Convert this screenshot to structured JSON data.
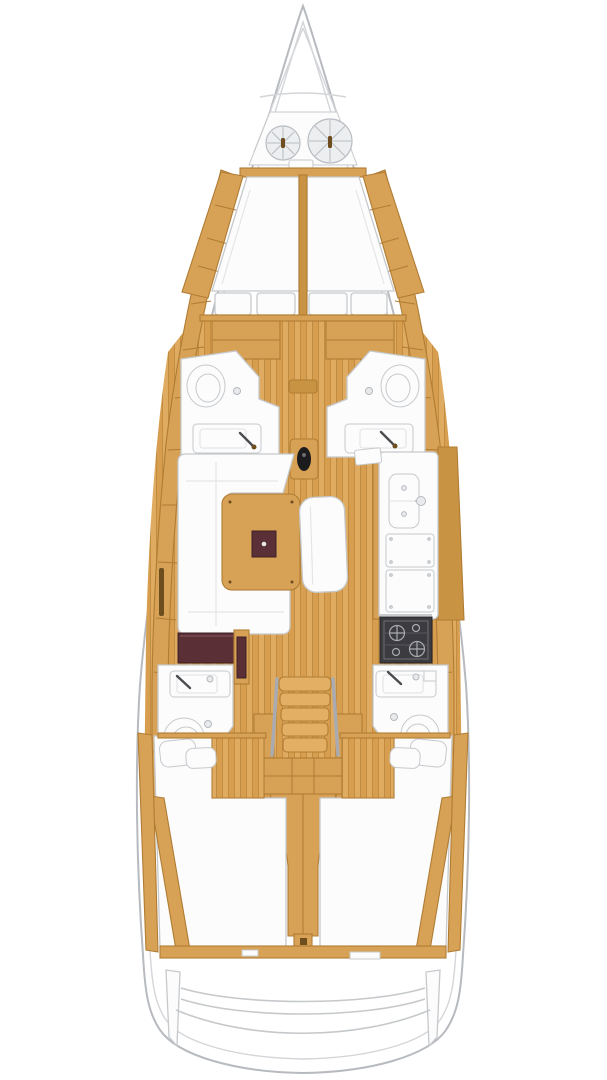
{
  "diagram": {
    "type": "boat-interior-floor-plan",
    "label": "sailboat interior layout top view, bow at top",
    "orientation": "bow-top",
    "features": {
      "bow": [
        "anchor-locker",
        "rope-coil-port",
        "rope-coil-starboard",
        "windlass",
        "stem-lines"
      ],
      "forward_cabin": [
        "v-berth-port-mattress",
        "v-berth-starboard-mattress",
        "berth-center-divider",
        "side-shelf-port",
        "side-shelf-starboard",
        "foot-cushion-1",
        "foot-cushion-2",
        "foot-cushion-3",
        "foot-cushion-4",
        "storage-locker-port",
        "storage-locker-starboard"
      ],
      "forward_head_port": [
        "toilet",
        "washbasin",
        "faucet",
        "floor-drain"
      ],
      "forward_head_starboard": [
        "toilet",
        "washbasin",
        "faucet",
        "floor-drain"
      ],
      "mast": [
        "mast-step-threshold",
        "mast-post"
      ],
      "salon": [
        "u-shaped-settee",
        "saloon-table",
        "table-folding-leaf",
        "bench-seat",
        "nav-seat",
        "chart-table"
      ],
      "galley": [
        "counter",
        "double-sink",
        "faucet",
        "locker-panel-upper",
        "locker-panel-lower",
        "stove-oven",
        "locker-door",
        "cabinet-face"
      ],
      "aft_head_port": [
        "washbasin",
        "faucet",
        "toilet",
        "floor-drain"
      ],
      "aft_head_starboard": [
        "washbasin",
        "faucet",
        "toilet",
        "floor-drain",
        "shelf-box"
      ],
      "companionway": [
        "stairs",
        "handrail-port",
        "handrail-starboard",
        "engine-compartment",
        "shaft-tunnel"
      ],
      "aft_cabin_port": [
        "double-berth",
        "pillows",
        "wood-floor",
        "structural-beam",
        "hull-stringer"
      ],
      "aft_cabin_starboard": [
        "double-berth",
        "pillows",
        "wood-floor",
        "structural-beam",
        "hull-stringer"
      ],
      "stern": [
        "aft-bulkhead-beam",
        "transom-panel-port",
        "transom-panel-starboard",
        "swim-platform-curves"
      ]
    }
  },
  "colors": {
    "page_bg": "#ffffff",
    "hull_fill": "#ffffff",
    "hull_stroke": "#b7babf",
    "deck_line": "#d3d5d9",
    "wood": "#d7a256",
    "wood_light": "#e2af64",
    "wood_dark": "#c99344",
    "wood_line": "#b07c33",
    "wood_slot": "#6e4d1e",
    "floor_a": "#dfab60",
    "floor_b": "#d69e4e",
    "floor_line": "#c08a3e",
    "white_item": "#fcfcfd",
    "item_stroke": "#c6c9cc",
    "item_shadow": "#e4e5e8",
    "maroon": "#5a2f36",
    "stove_dark": "#3c3c40",
    "stove_metal": "#a9abb0",
    "coil_fill": "#eceeef",
    "coil_stroke": "#b9bdc2",
    "black": "#1c1c1e"
  }
}
